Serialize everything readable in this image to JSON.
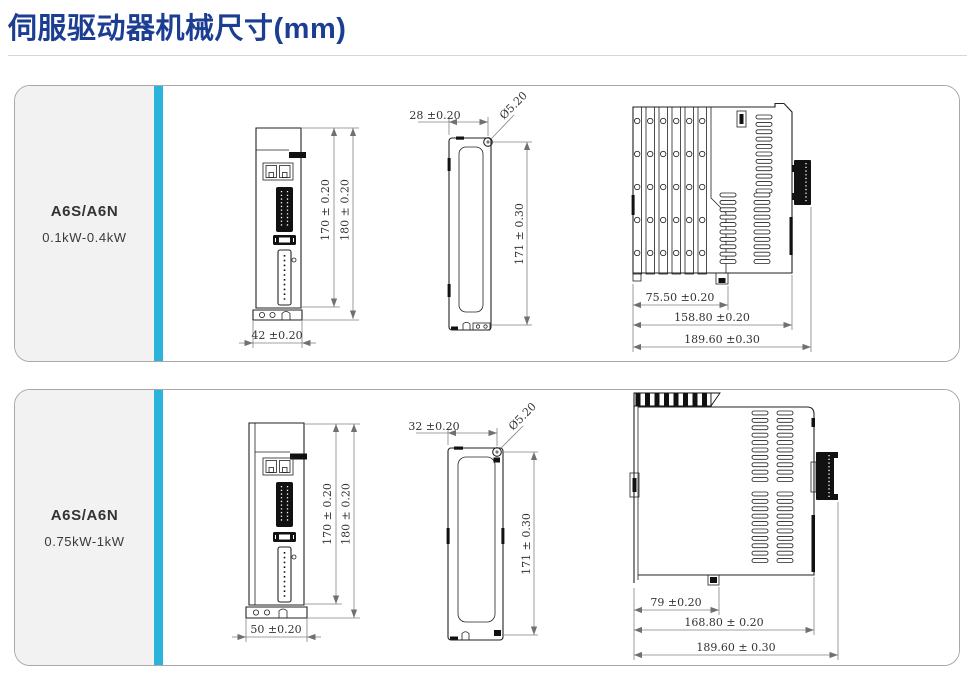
{
  "title": "伺服驱动器机械尺寸(mm)",
  "colors": {
    "accent_bar": "#2ab4dc",
    "title_text": "#1c3e92"
  },
  "panels": [
    {
      "model": "A6S/A6N",
      "power": "0.1kW-0.4kW",
      "front": {
        "height_inner": "170 ± 0.20",
        "height_outer": "180 ± 0.20",
        "width": "42 ±0.20"
      },
      "side": {
        "hole_offset": "28 ±0.20",
        "hole_dia": "Ø5.20",
        "height": "171 ± 0.30"
      },
      "profile": {
        "depth_fins": "75.50 ±0.20",
        "depth_body": "158.80 ±0.20",
        "depth_total": "189.60 ±0.30"
      }
    },
    {
      "model": "A6S/A6N",
      "power": "0.75kW-1kW",
      "front": {
        "height_inner": "170 ± 0.20",
        "height_outer": "180 ± 0.20",
        "width": "50 ±0.20"
      },
      "side": {
        "hole_offset": "32 ±0.20",
        "hole_dia": "Ø5.20",
        "height": "171 ± 0.30"
      },
      "profile": {
        "depth_fins": "79 ±0.20",
        "depth_body": "168.80 ± 0.20",
        "depth_total": "189.60 ± 0.30"
      }
    }
  ]
}
